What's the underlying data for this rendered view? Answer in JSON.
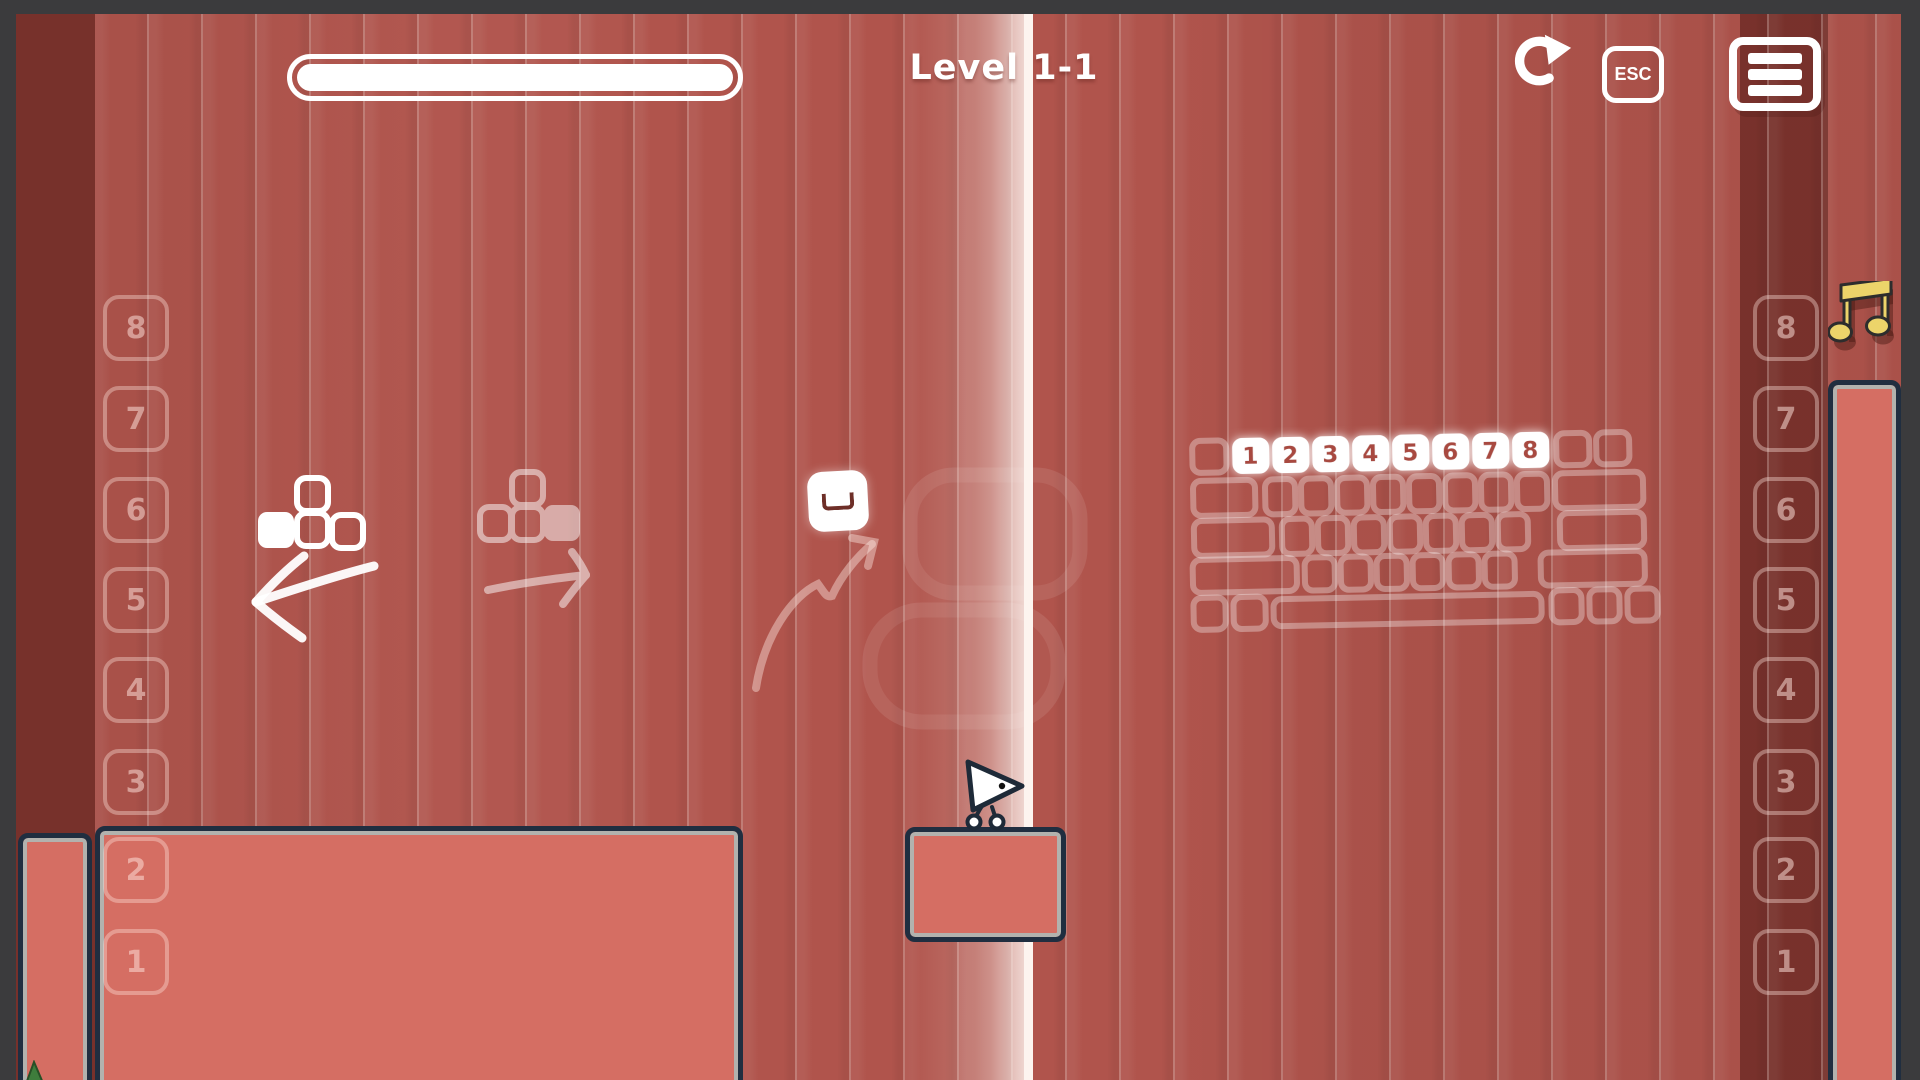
{
  "header": {
    "level_label": "Level 1-1"
  },
  "topbar": {
    "progress_percent": 100,
    "esc_label": "ESC",
    "icons": {
      "restart": "circular-redo-arrow",
      "escape": "esc-key",
      "menu": "hamburger"
    }
  },
  "hud": {
    "music_icon": "music-note"
  },
  "left_scale": {
    "keys": [
      "8",
      "7",
      "6",
      "5",
      "4",
      "3",
      "2",
      "1"
    ]
  },
  "right_scale": {
    "keys": [
      "8",
      "7",
      "6",
      "5",
      "4",
      "3",
      "2",
      "1"
    ]
  },
  "keyboard_hint": {
    "highlight_keys": [
      "1",
      "2",
      "3",
      "4",
      "5",
      "6",
      "7",
      "8"
    ]
  },
  "tutorial": {
    "move_left_icon": "arrow-keys-left-pressed",
    "move_right_icon": "arrow-keys-right-pressed",
    "left_arrow": "hand-drawn-left-arrow",
    "right_arrow": "hand-drawn-right-arrow",
    "jump_key_icon": "spacebar-key",
    "jump_arrow": "bounce-arc-arrow"
  },
  "colors": {
    "background_red": "#b0544c",
    "dark_column": "#7c332d",
    "frame_gray": "#3b3b3d",
    "platform_fill": "#d56e63",
    "platform_border": "#202e40",
    "platform_inner_border": "#a9c3c0",
    "beam_white": "#fdf4ef",
    "note_yellow": "#ecd46a",
    "key_number_red": "#a84a40"
  }
}
